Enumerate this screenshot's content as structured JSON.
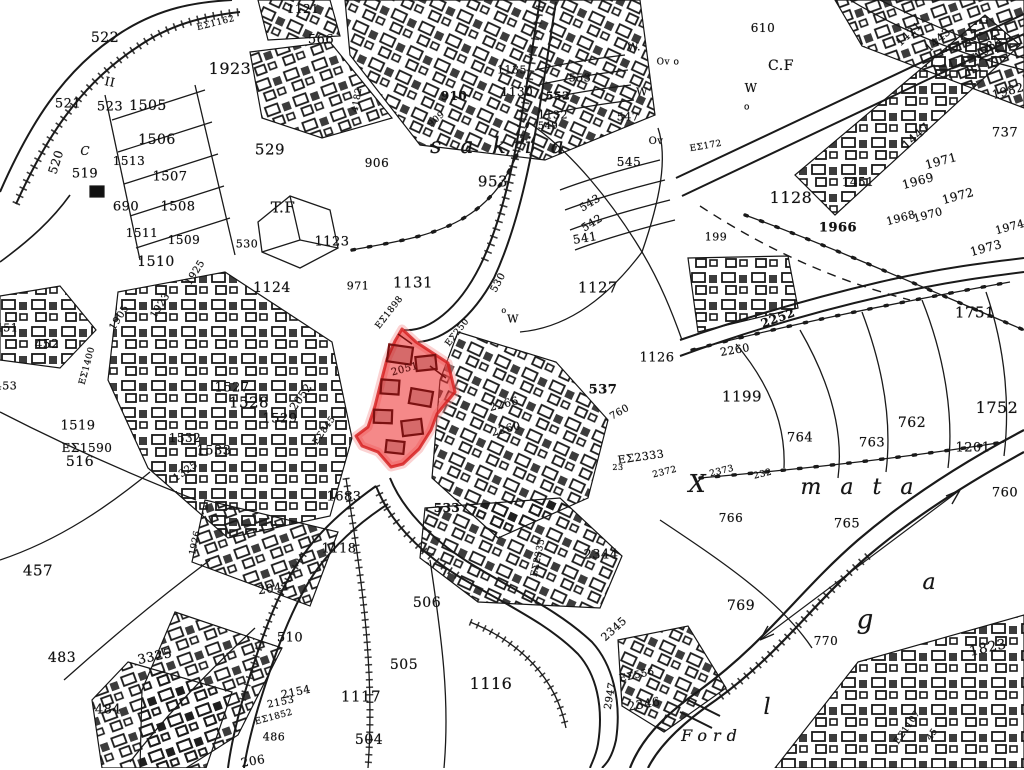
{
  "map": {
    "title": "cadastral survey map scan with highlighted parcel",
    "background": "#ffffff",
    "ink_color": "#1a1a1a",
    "highlight_fill": "#ee3434",
    "highlight_fill_opacity": 0.58,
    "highlight_stroke": "#d41d1d",
    "red_parcel": {
      "points": "402,329 416,342 448,363 455,392 437,414 431,430 419,449 403,464 391,467 378,452 362,446 356,436 368,427 375,406 380,386 387,359 395,341"
    },
    "place_names": [
      "s a k i a",
      "m a t a",
      "g a",
      "Ford"
    ],
    "labels": [
      {
        "t": "522",
        "x": 105,
        "y": 38,
        "s": 14
      },
      {
        "t": "521",
        "x": 68,
        "y": 104,
        "s": 13
      },
      {
        "t": "II",
        "x": 110,
        "y": 82,
        "s": 12,
        "r": 12
      },
      {
        "t": "523",
        "x": 110,
        "y": 107,
        "s": 13
      },
      {
        "t": "1505",
        "x": 148,
        "y": 106,
        "s": 14
      },
      {
        "t": "1506",
        "x": 157,
        "y": 140,
        "s": 14
      },
      {
        "t": "1513",
        "x": 129,
        "y": 161,
        "s": 12
      },
      {
        "t": "1507",
        "x": 170,
        "y": 177,
        "s": 13
      },
      {
        "t": "690",
        "x": 126,
        "y": 207,
        "s": 13
      },
      {
        "t": "1508",
        "x": 178,
        "y": 207,
        "s": 13
      },
      {
        "t": "1511",
        "x": 142,
        "y": 233,
        "s": 12
      },
      {
        "t": "1509",
        "x": 184,
        "y": 240,
        "s": 12
      },
      {
        "t": "1510",
        "x": 156,
        "y": 262,
        "s": 14
      },
      {
        "t": "520",
        "x": 56,
        "y": 162,
        "s": 12,
        "r": -72
      },
      {
        "t": "519",
        "x": 85,
        "y": 174,
        "s": 13
      },
      {
        "t": "C",
        "x": 88,
        "y": 151,
        "s": 12,
        "i": 1
      },
      {
        "t": "1923",
        "x": 230,
        "y": 69,
        "s": 16
      },
      {
        "t": "EΣ1162",
        "x": 216,
        "y": 24,
        "s": 9,
        "r": -14
      },
      {
        "t": "1121",
        "x": 303,
        "y": 9,
        "s": 12
      },
      {
        "t": "566",
        "x": 321,
        "y": 40,
        "s": 13
      },
      {
        "t": "529",
        "x": 270,
        "y": 150,
        "s": 15
      },
      {
        "t": "T.F",
        "x": 283,
        "y": 208,
        "s": 15
      },
      {
        "t": "530",
        "x": 247,
        "y": 244,
        "s": 11
      },
      {
        "t": "1123",
        "x": 332,
        "y": 242,
        "s": 13
      },
      {
        "t": "1124",
        "x": 272,
        "y": 288,
        "s": 14
      },
      {
        "t": "452",
        "x": 47,
        "y": 344,
        "s": 12
      },
      {
        "t": "451",
        "x": 7,
        "y": 328,
        "s": 11
      },
      {
        "t": "453",
        "x": 6,
        "y": 386,
        "s": 11
      },
      {
        "t": "1925",
        "x": 196,
        "y": 273,
        "s": 10,
        "r": -58
      },
      {
        "t": "1923",
        "x": 161,
        "y": 306,
        "s": 10,
        "r": -58
      },
      {
        "t": "1905",
        "x": 120,
        "y": 318,
        "s": 10,
        "r": -58
      },
      {
        "t": "EΣ1400",
        "x": 88,
        "y": 366,
        "s": 9,
        "r": -75
      },
      {
        "t": "1519",
        "x": 78,
        "y": 426,
        "s": 13
      },
      {
        "t": "EΣ1590",
        "x": 87,
        "y": 448,
        "s": 12
      },
      {
        "t": "516",
        "x": 80,
        "y": 462,
        "s": 14
      },
      {
        "t": "906",
        "x": 377,
        "y": 163,
        "s": 12
      },
      {
        "t": "4182",
        "x": 358,
        "y": 100,
        "s": 9,
        "r": -80
      },
      {
        "t": "910",
        "x": 454,
        "y": 96,
        "s": 12,
        "b": 1
      },
      {
        "t": "909",
        "x": 437,
        "y": 120,
        "s": 9,
        "r": -40
      },
      {
        "t": "1135",
        "x": 512,
        "y": 70,
        "s": 11
      },
      {
        "t": "1130",
        "x": 517,
        "y": 92,
        "s": 12
      },
      {
        "t": "553",
        "x": 580,
        "y": 78,
        "s": 11
      },
      {
        "t": "552",
        "x": 558,
        "y": 96,
        "s": 11,
        "b": 1
      },
      {
        "t": "1132",
        "x": 553,
        "y": 115,
        "s": 11
      },
      {
        "t": "549",
        "x": 548,
        "y": 127,
        "s": 10
      },
      {
        "t": "W.",
        "x": 634,
        "y": 47,
        "s": 11
      },
      {
        "t": "Ov o",
        "x": 668,
        "y": 63,
        "s": 9
      },
      {
        "t": "W",
        "x": 642,
        "y": 92,
        "s": 11
      },
      {
        "t": "Ov",
        "x": 656,
        "y": 142,
        "s": 10
      },
      {
        "t": "547",
        "x": 628,
        "y": 117,
        "s": 11
      },
      {
        "t": "545",
        "x": 629,
        "y": 162,
        "s": 12
      },
      {
        "t": "543",
        "x": 590,
        "y": 203,
        "s": 11,
        "r": -32
      },
      {
        "t": "542",
        "x": 592,
        "y": 223,
        "s": 11,
        "r": -32
      },
      {
        "t": "541",
        "x": 585,
        "y": 238,
        "s": 12,
        "r": -10
      },
      {
        "t": "s a k i a",
        "x": 500,
        "y": 147,
        "s": 22,
        "i": 1,
        "n": "place-name-sakia"
      },
      {
        "t": "953",
        "x": 493,
        "y": 182,
        "s": 15
      },
      {
        "t": "610",
        "x": 763,
        "y": 28,
        "s": 12
      },
      {
        "t": "C.F",
        "x": 781,
        "y": 66,
        "s": 14
      },
      {
        "t": "W",
        "x": 751,
        "y": 88,
        "s": 12
      },
      {
        "t": "o",
        "x": 747,
        "y": 108,
        "s": 9
      },
      {
        "t": "EΣ172",
        "x": 706,
        "y": 147,
        "s": 9,
        "r": -10
      },
      {
        "t": "199",
        "x": 716,
        "y": 237,
        "s": 11
      },
      {
        "t": "1128",
        "x": 791,
        "y": 198,
        "s": 16
      },
      {
        "t": "1451",
        "x": 858,
        "y": 182,
        "s": 12
      },
      {
        "t": "1447",
        "x": 916,
        "y": 136,
        "s": 12,
        "r": -42
      },
      {
        "t": "1443",
        "x": 938,
        "y": 40,
        "s": 11,
        "r": -42
      },
      {
        "t": "1421",
        "x": 909,
        "y": 34,
        "s": 11,
        "r": -42
      },
      {
        "t": "1984",
        "x": 988,
        "y": 48,
        "s": 12,
        "r": -42
      },
      {
        "t": "1982",
        "x": 1008,
        "y": 91,
        "s": 12,
        "r": -15
      },
      {
        "t": "737",
        "x": 1005,
        "y": 133,
        "s": 13
      },
      {
        "t": "1966",
        "x": 838,
        "y": 228,
        "s": 13,
        "b": 1
      },
      {
        "t": "1969",
        "x": 918,
        "y": 181,
        "s": 12,
        "r": -15
      },
      {
        "t": "1971",
        "x": 941,
        "y": 161,
        "s": 12,
        "r": -15
      },
      {
        "t": "1968",
        "x": 901,
        "y": 218,
        "s": 11,
        "r": -15
      },
      {
        "t": "1970",
        "x": 928,
        "y": 215,
        "s": 11,
        "r": -15
      },
      {
        "t": "1972",
        "x": 958,
        "y": 196,
        "s": 12,
        "r": -15
      },
      {
        "t": "1973",
        "x": 986,
        "y": 248,
        "s": 12,
        "r": -15
      },
      {
        "t": "1974",
        "x": 1010,
        "y": 227,
        "s": 11,
        "r": -15
      },
      {
        "t": "971",
        "x": 358,
        "y": 286,
        "s": 11
      },
      {
        "t": "1131",
        "x": 413,
        "y": 283,
        "s": 15
      },
      {
        "t": "EΣ1898",
        "x": 390,
        "y": 313,
        "s": 9,
        "r": -52
      },
      {
        "t": "530",
        "x": 499,
        "y": 283,
        "s": 10,
        "r": -62
      },
      {
        "t": "o",
        "x": 504,
        "y": 311,
        "s": 8
      },
      {
        "t": "W",
        "x": 513,
        "y": 319,
        "s": 11
      },
      {
        "t": "EΣ250",
        "x": 458,
        "y": 333,
        "s": 9,
        "r": -52
      },
      {
        "t": "1127",
        "x": 598,
        "y": 288,
        "s": 15
      },
      {
        "t": "1126",
        "x": 657,
        "y": 358,
        "s": 13
      },
      {
        "t": "537",
        "x": 603,
        "y": 390,
        "s": 13,
        "b": 1
      },
      {
        "t": "760",
        "x": 620,
        "y": 413,
        "s": 10,
        "r": -30
      },
      {
        "t": "2051",
        "x": 405,
        "y": 370,
        "s": 10,
        "r": -15,
        "d": 1
      },
      {
        "t": "2052",
        "x": 301,
        "y": 397,
        "s": 11,
        "r": -55
      },
      {
        "t": "EΣ845",
        "x": 325,
        "y": 431,
        "s": 9,
        "r": -55
      },
      {
        "t": "1527",
        "x": 232,
        "y": 388,
        "s": 13
      },
      {
        "t": "1528",
        "x": 249,
        "y": 403,
        "s": 15
      },
      {
        "t": "1529",
        "x": 280,
        "y": 419,
        "s": 13
      },
      {
        "t": "1532",
        "x": 185,
        "y": 438,
        "s": 12
      },
      {
        "t": "1533",
        "x": 214,
        "y": 451,
        "s": 13
      },
      {
        "t": "1325",
        "x": 186,
        "y": 472,
        "s": 10,
        "r": -35
      },
      {
        "t": "2266",
        "x": 504,
        "y": 404,
        "s": 11,
        "r": -14
      },
      {
        "t": "2260",
        "x": 506,
        "y": 429,
        "s": 11,
        "r": -14
      },
      {
        "t": "EΣ2333",
        "x": 641,
        "y": 457,
        "s": 11,
        "r": -8
      },
      {
        "t": "23",
        "x": 618,
        "y": 468,
        "s": 8
      },
      {
        "t": "2372",
        "x": 665,
        "y": 473,
        "s": 9,
        "r": -14
      },
      {
        "t": "2373",
        "x": 722,
        "y": 472,
        "s": 9,
        "r": -14
      },
      {
        "t": "232",
        "x": 763,
        "y": 475,
        "s": 9,
        "r": -14
      },
      {
        "t": "X",
        "x": 700,
        "y": 484,
        "s": 24,
        "i": 1,
        "n": "script-letter"
      },
      {
        "t": "1683",
        "x": 344,
        "y": 497,
        "s": 13
      },
      {
        "t": "533",
        "x": 447,
        "y": 508,
        "s": 12,
        "b": 1
      },
      {
        "t": "2252",
        "x": 778,
        "y": 318,
        "s": 12,
        "r": -20,
        "b": 1
      },
      {
        "t": "2260",
        "x": 735,
        "y": 350,
        "s": 11,
        "r": -10
      },
      {
        "t": "1199",
        "x": 742,
        "y": 397,
        "s": 15
      },
      {
        "t": "1751",
        "x": 975,
        "y": 313,
        "s": 15
      },
      {
        "t": "1752",
        "x": 997,
        "y": 408,
        "s": 16
      },
      {
        "t": "764",
        "x": 800,
        "y": 438,
        "s": 13
      },
      {
        "t": "763",
        "x": 872,
        "y": 443,
        "s": 13
      },
      {
        "t": "762",
        "x": 912,
        "y": 423,
        "s": 14
      },
      {
        "t": "1201",
        "x": 973,
        "y": 448,
        "s": 13
      },
      {
        "t": "760",
        "x": 1005,
        "y": 493,
        "s": 13
      },
      {
        "t": "m a t a",
        "x": 860,
        "y": 488,
        "s": 22,
        "i": 1,
        "n": "place-name-mata"
      },
      {
        "t": "766",
        "x": 731,
        "y": 518,
        "s": 12
      },
      {
        "t": "765",
        "x": 847,
        "y": 524,
        "s": 13
      },
      {
        "t": "457",
        "x": 38,
        "y": 571,
        "s": 15
      },
      {
        "t": "483",
        "x": 62,
        "y": 658,
        "s": 14
      },
      {
        "t": "484",
        "x": 108,
        "y": 710,
        "s": 13
      },
      {
        "t": "1926",
        "x": 196,
        "y": 543,
        "s": 9,
        "r": -78
      },
      {
        "t": "3325",
        "x": 155,
        "y": 657,
        "s": 13,
        "r": -12
      },
      {
        "t": "2041",
        "x": 274,
        "y": 588,
        "s": 12,
        "r": -8
      },
      {
        "t": "510",
        "x": 290,
        "y": 638,
        "s": 13
      },
      {
        "t": "2154",
        "x": 296,
        "y": 692,
        "s": 11,
        "r": -12
      },
      {
        "t": "2153",
        "x": 281,
        "y": 703,
        "s": 10,
        "r": -12
      },
      {
        "t": "EΣ1852",
        "x": 274,
        "y": 718,
        "s": 9,
        "r": -15
      },
      {
        "t": "486",
        "x": 274,
        "y": 737,
        "s": 11
      },
      {
        "t": "206",
        "x": 253,
        "y": 761,
        "s": 12,
        "r": -10
      },
      {
        "t": "1118",
        "x": 339,
        "y": 549,
        "s": 13
      },
      {
        "t": "506",
        "x": 427,
        "y": 603,
        "s": 14
      },
      {
        "t": "505",
        "x": 404,
        "y": 665,
        "s": 14
      },
      {
        "t": "1117",
        "x": 361,
        "y": 697,
        "s": 15
      },
      {
        "t": "504",
        "x": 369,
        "y": 740,
        "s": 14
      },
      {
        "t": "1116",
        "x": 491,
        "y": 684,
        "s": 16
      },
      {
        "t": "EΣ2335",
        "x": 539,
        "y": 558,
        "s": 9,
        "r": -78
      },
      {
        "t": "2344",
        "x": 601,
        "y": 555,
        "s": 13
      },
      {
        "t": "2345",
        "x": 614,
        "y": 629,
        "s": 11,
        "r": -42
      },
      {
        "t": "EΣ556",
        "x": 637,
        "y": 676,
        "s": 10,
        "r": -12
      },
      {
        "t": "2947",
        "x": 611,
        "y": 696,
        "s": 10,
        "r": -80
      },
      {
        "t": "2346",
        "x": 644,
        "y": 704,
        "s": 12,
        "r": -10
      },
      {
        "t": "769",
        "x": 741,
        "y": 606,
        "s": 14
      },
      {
        "t": "770",
        "x": 826,
        "y": 641,
        "s": 12
      },
      {
        "t": "l",
        "x": 770,
        "y": 708,
        "s": 22,
        "i": 1,
        "n": "script-letter"
      },
      {
        "t": "Ford",
        "x": 712,
        "y": 736,
        "s": 16,
        "i": 1,
        "n": "place-name-ford"
      },
      {
        "t": "g",
        "x": 868,
        "y": 620,
        "s": 26,
        "i": 1,
        "n": "script-letter"
      },
      {
        "t": "a",
        "x": 932,
        "y": 583,
        "s": 22,
        "i": 1,
        "n": "script-letter"
      },
      {
        "t": "1823",
        "x": 988,
        "y": 648,
        "s": 14,
        "r": -12
      },
      {
        "t": "EΣ1107",
        "x": 908,
        "y": 728,
        "s": 9,
        "r": -55
      },
      {
        "t": "45",
        "x": 933,
        "y": 735,
        "s": 9,
        "r": -55
      }
    ]
  }
}
